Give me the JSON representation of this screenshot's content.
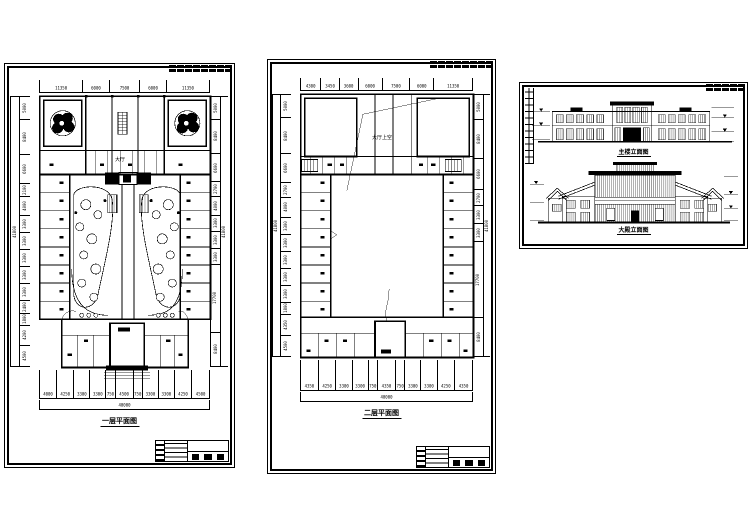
{
  "page": {
    "background": "#ffffff",
    "line_color": "#000000"
  },
  "sheet1": {
    "title": "一层平面图",
    "hall_label": "大厅",
    "top_dims": [
      "11350",
      "6000",
      "7500",
      "6000",
      "11350"
    ],
    "bottom_dims": [
      "4000",
      "4250",
      "3300",
      "3300",
      "750",
      "4500",
      "750",
      "3300",
      "3300",
      "4250",
      "4500"
    ],
    "bottom_total": "40000",
    "left_dims": [
      "5000",
      "8400",
      "6600",
      "2100",
      "4000",
      "3300",
      "3300",
      "3300",
      "3300",
      "3300",
      "2400",
      "1800",
      "4200",
      "4500"
    ],
    "left_total": "41800",
    "right_dims": [
      "5000",
      "8400",
      "6600",
      "2700",
      "4000",
      "3300",
      "3300",
      "3300",
      "17700",
      "8400"
    ],
    "right_total": "41800"
  },
  "sheet2": {
    "title": "二层平面图",
    "void_label": "大厅上空",
    "top_dims": [
      "4300",
      "3450",
      "3600",
      "6000",
      "7500",
      "6000",
      "11350"
    ],
    "bottom_dims": [
      "4350",
      "4250",
      "3300",
      "3300",
      "750",
      "4350",
      "750",
      "3300",
      "3300",
      "4250",
      "4350"
    ],
    "bottom_total": "40000",
    "left_dims": [
      "5000",
      "8400",
      "6600",
      "2700",
      "4000",
      "3300",
      "3300",
      "3300",
      "3300",
      "3300",
      "1800",
      "4350",
      "4500"
    ],
    "left_total": "41800",
    "right_dims": [
      "5000",
      "8400",
      "6600",
      "2700",
      "3300",
      "3300",
      "17700",
      "8400"
    ],
    "right_total": "41800"
  },
  "sheet3": {
    "upper_title": "主楼立面图",
    "lower_title": "大殿立面图"
  }
}
